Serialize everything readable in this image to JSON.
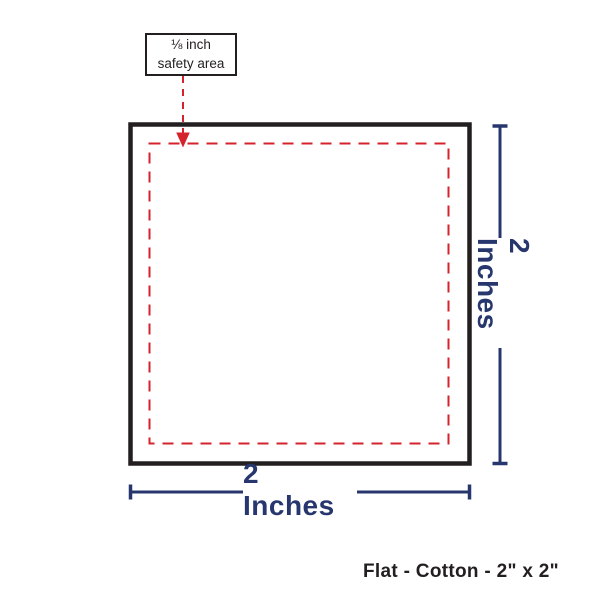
{
  "diagram": {
    "callout": {
      "line1": "⅛ inch",
      "line2": "safety area"
    },
    "dimensions": {
      "width_label": "2 Inches",
      "height_label": "2 Inches"
    },
    "caption": "Flat - Cotton - 2\" x 2\"",
    "colors": {
      "outline": "#231f20",
      "safety": "#d5232d",
      "dimension": "#27376e"
    }
  }
}
